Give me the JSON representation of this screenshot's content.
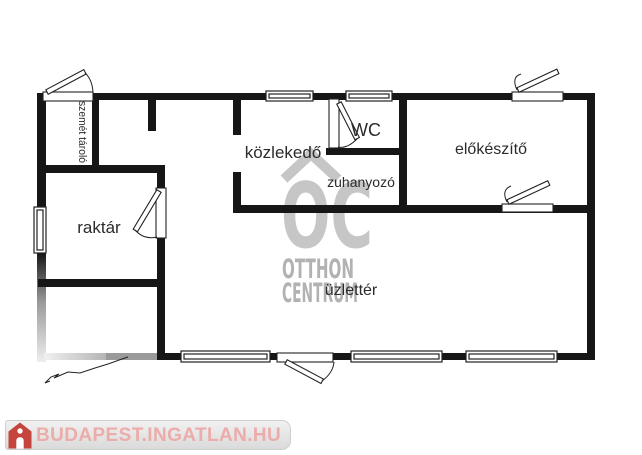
{
  "page": {
    "background": "#ffffff"
  },
  "floorplan": {
    "wall_color": "#161616",
    "rooms": [
      {
        "name": "szemet-tarolo",
        "label": "szemét tároló"
      },
      {
        "name": "raktar",
        "label": "raktár"
      },
      {
        "name": "kozlekedo",
        "label": "közlekedő"
      },
      {
        "name": "wc",
        "label": "WC"
      },
      {
        "name": "zuhanyozo",
        "label": "zuhanyozó"
      },
      {
        "name": "elokeszito",
        "label": "előkészítő"
      },
      {
        "name": "uzletter",
        "label": "üzlettér"
      }
    ]
  },
  "watermark": {
    "monogram": "OC",
    "line1": "OTTHON",
    "line2": "CENTRUM",
    "logo_color": "#c6c6c6",
    "text_color": "#b2b2b2"
  },
  "branding": {
    "text": "BUDAPEST.INGATLAN.HU",
    "text_color": "#ecaca9",
    "icon_color": "#c4453c",
    "bar_color": "#e4e4e4"
  }
}
